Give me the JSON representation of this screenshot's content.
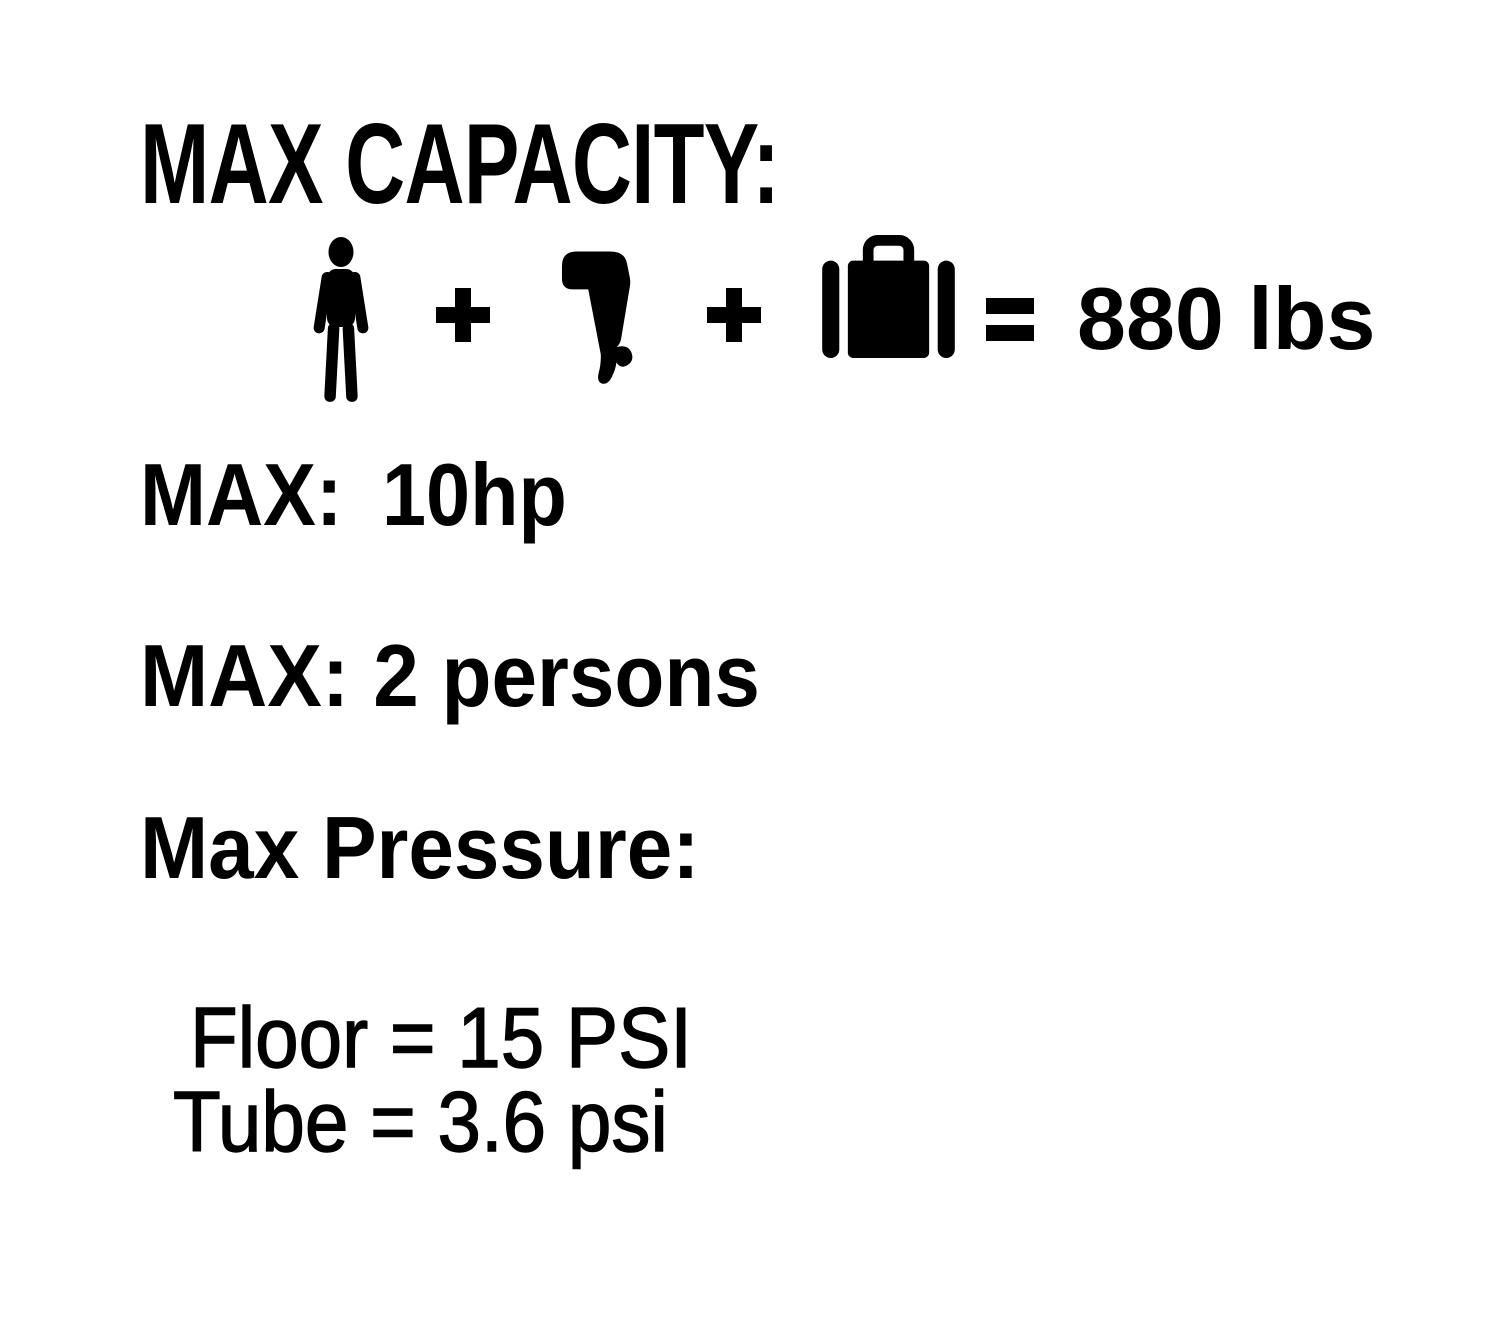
{
  "canvas": {
    "background": "#ffffff",
    "ink": "#000000"
  },
  "max_capacity": {
    "title": "MAX CAPACITY:",
    "equation": {
      "icons": {
        "person": "person-icon",
        "motor": "outboard-motor-icon",
        "luggage": "luggage-icon"
      },
      "plus": "+",
      "equals": "=",
      "total": "880 lbs"
    }
  },
  "max_hp": {
    "label": "MAX:",
    "value": "10hp"
  },
  "max_persons": {
    "label": "MAX:",
    "value": "2 persons"
  },
  "max_pressure": {
    "title": "Max Pressure:",
    "lines": [
      "Floor = 15 PSI",
      "Tube = 3.6 psi"
    ]
  }
}
